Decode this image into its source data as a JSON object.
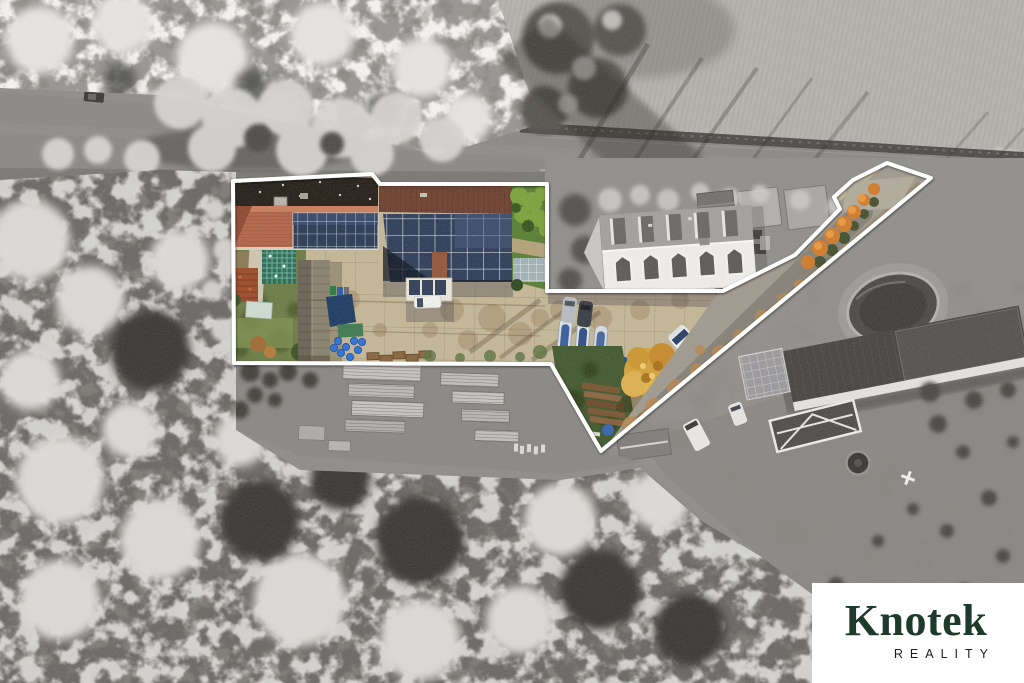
{
  "brand": {
    "name": "Knotek",
    "tagline": "REALITY"
  },
  "watermark": {
    "background": "#ffffff",
    "name_color": "#1e3a2b",
    "tagline_color": "#1d1d1b"
  },
  "overlay": {
    "boundary_color": "#ffffff"
  },
  "palette": {
    "desaturated_surroundings": "#8f8d8a",
    "concrete_yard": "#c4b797",
    "terracotta_roof": "#b2664a",
    "dark_moss_roof": "#262019",
    "solar_panels": "#2f3e59",
    "grass": "#5d8434",
    "autumn_tree": "#d2a23c",
    "driveway_leaves": "#b8874e",
    "blue_barrels": "#2f72d4"
  }
}
